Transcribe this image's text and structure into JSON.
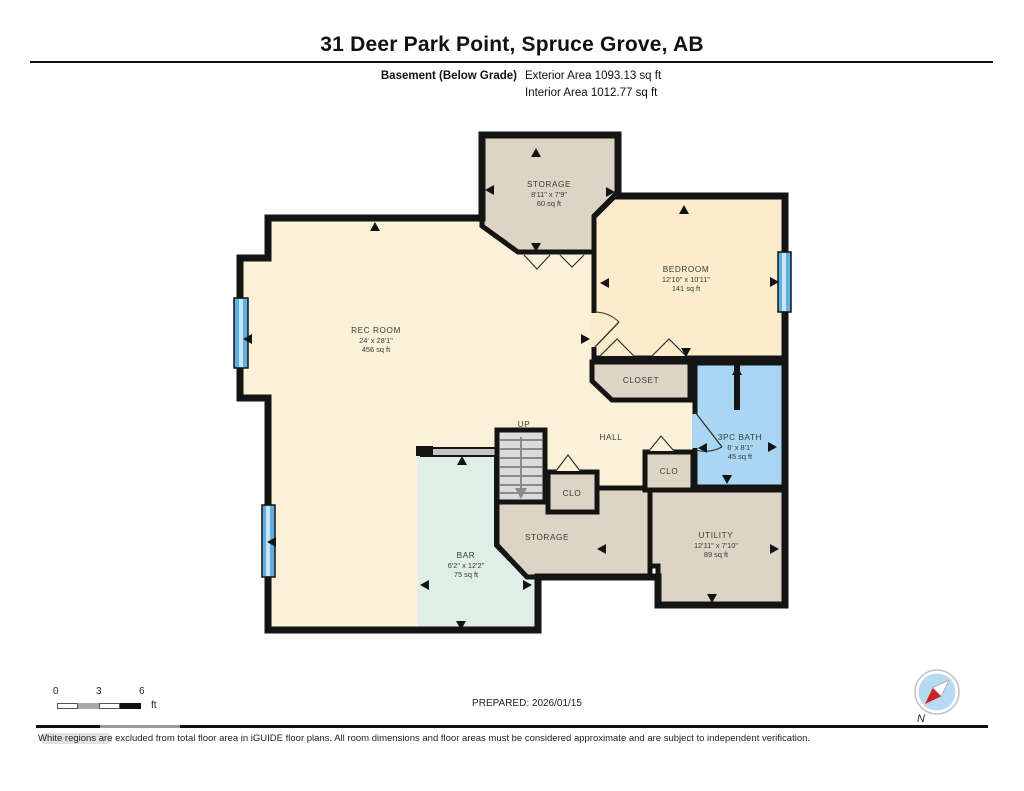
{
  "header": {
    "title": "31 Deer Park Point, Spruce Grove, AB",
    "floor_label": "Basement (Below Grade)",
    "exterior_area": "Exterior Area 1093.13 sq ft",
    "interior_area": "Interior Area 1012.77 sq ft"
  },
  "rooms": {
    "storage_top": {
      "name": "STORAGE",
      "dims": "8'11\" x 7'9\"",
      "area": "60 sq ft"
    },
    "bedroom": {
      "name": "BEDROOM",
      "dims": "12'10\" x 10'11\"",
      "area": "141 sq ft"
    },
    "rec_room": {
      "name": "REC ROOM",
      "dims": "24' x 28'1\"",
      "area": "456 sq ft"
    },
    "closet": {
      "name": "CLOSET"
    },
    "bath": {
      "name": "3PC BATH",
      "dims": "6' x 8'1\"",
      "area": "45 sq ft"
    },
    "hall": {
      "name": "HALL"
    },
    "clo_left": {
      "name": "CLO"
    },
    "clo_right": {
      "name": "CLO"
    },
    "stairs": {
      "label": "UP"
    },
    "bar": {
      "name": "BAR",
      "dims": "6'2\" x 12'2\"",
      "area": "75 sq ft"
    },
    "storage_bottom": {
      "name": "STORAGE"
    },
    "utility": {
      "name": "UTILITY",
      "dims": "12'11\" x 7'10\"",
      "area": "89 sq ft"
    }
  },
  "scale_bar": {
    "labels": [
      "0",
      "3",
      "6"
    ],
    "unit": "ft"
  },
  "compass": {
    "north_label": "N"
  },
  "footer": {
    "prepared": "PREPARED: 2026/01/15",
    "disclaimer": "White regions are excluded from total floor area in iGUIDE floor plans. All room dimensions and floor areas must be considered approximate and are subject to independent verification."
  },
  "colors": {
    "wall": "#141414",
    "room_yellow": "#faf1d8",
    "bedroom_yellow": "#fbeccb",
    "tan": "#ddd4c5",
    "bath_blue": "#a9d6f2",
    "bar_mint": "#dfeee6",
    "stair_grey": "#dcdcdc",
    "window_blue": "#5fb0e0",
    "window_light": "#c9e6f6",
    "compass_blue": "#b5daf1",
    "compass_red": "#cc2222"
  }
}
